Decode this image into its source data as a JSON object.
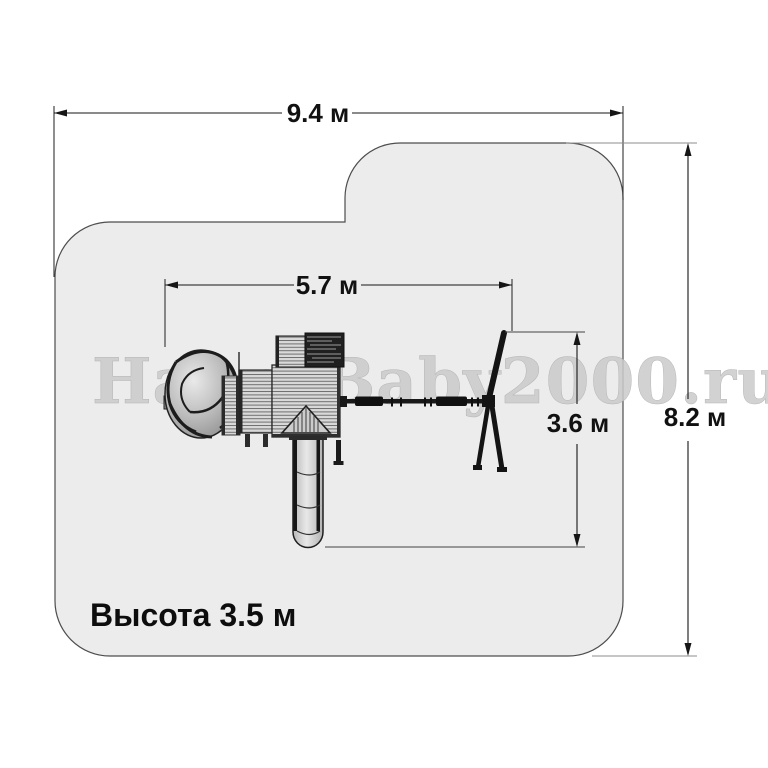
{
  "diagram": {
    "kind": "playground-safety-zone-plan",
    "watermark": "HappyBaby2000.ru",
    "dimensions": {
      "total_width": "9.4 м",
      "total_height": "8.2 м",
      "equipment_length": "5.7 м",
      "swing_zone_depth": "3.6 м",
      "equipment_height_note": "Высота 3.5 м"
    },
    "colors": {
      "background": "#ffffff",
      "safety_zone_fill": "#ececec",
      "safety_zone_border": "#4d4d4d",
      "dimension_lines": "#161616",
      "equipment_dark": "#1b1b1b",
      "watermark_gray": "#cbcbcb"
    },
    "parts": {
      "spiral_slide": "spiral-tube-slide-icon",
      "tower": "tower-deck-icon",
      "roof": "roof-triangle-icon",
      "climbing_wall": "climbing-wall-icon",
      "tube_slide": "straight-tube-slide-icon",
      "swing_beam": "swing-beam-icon",
      "swing_frame": "swing-a-frame-icon"
    }
  }
}
